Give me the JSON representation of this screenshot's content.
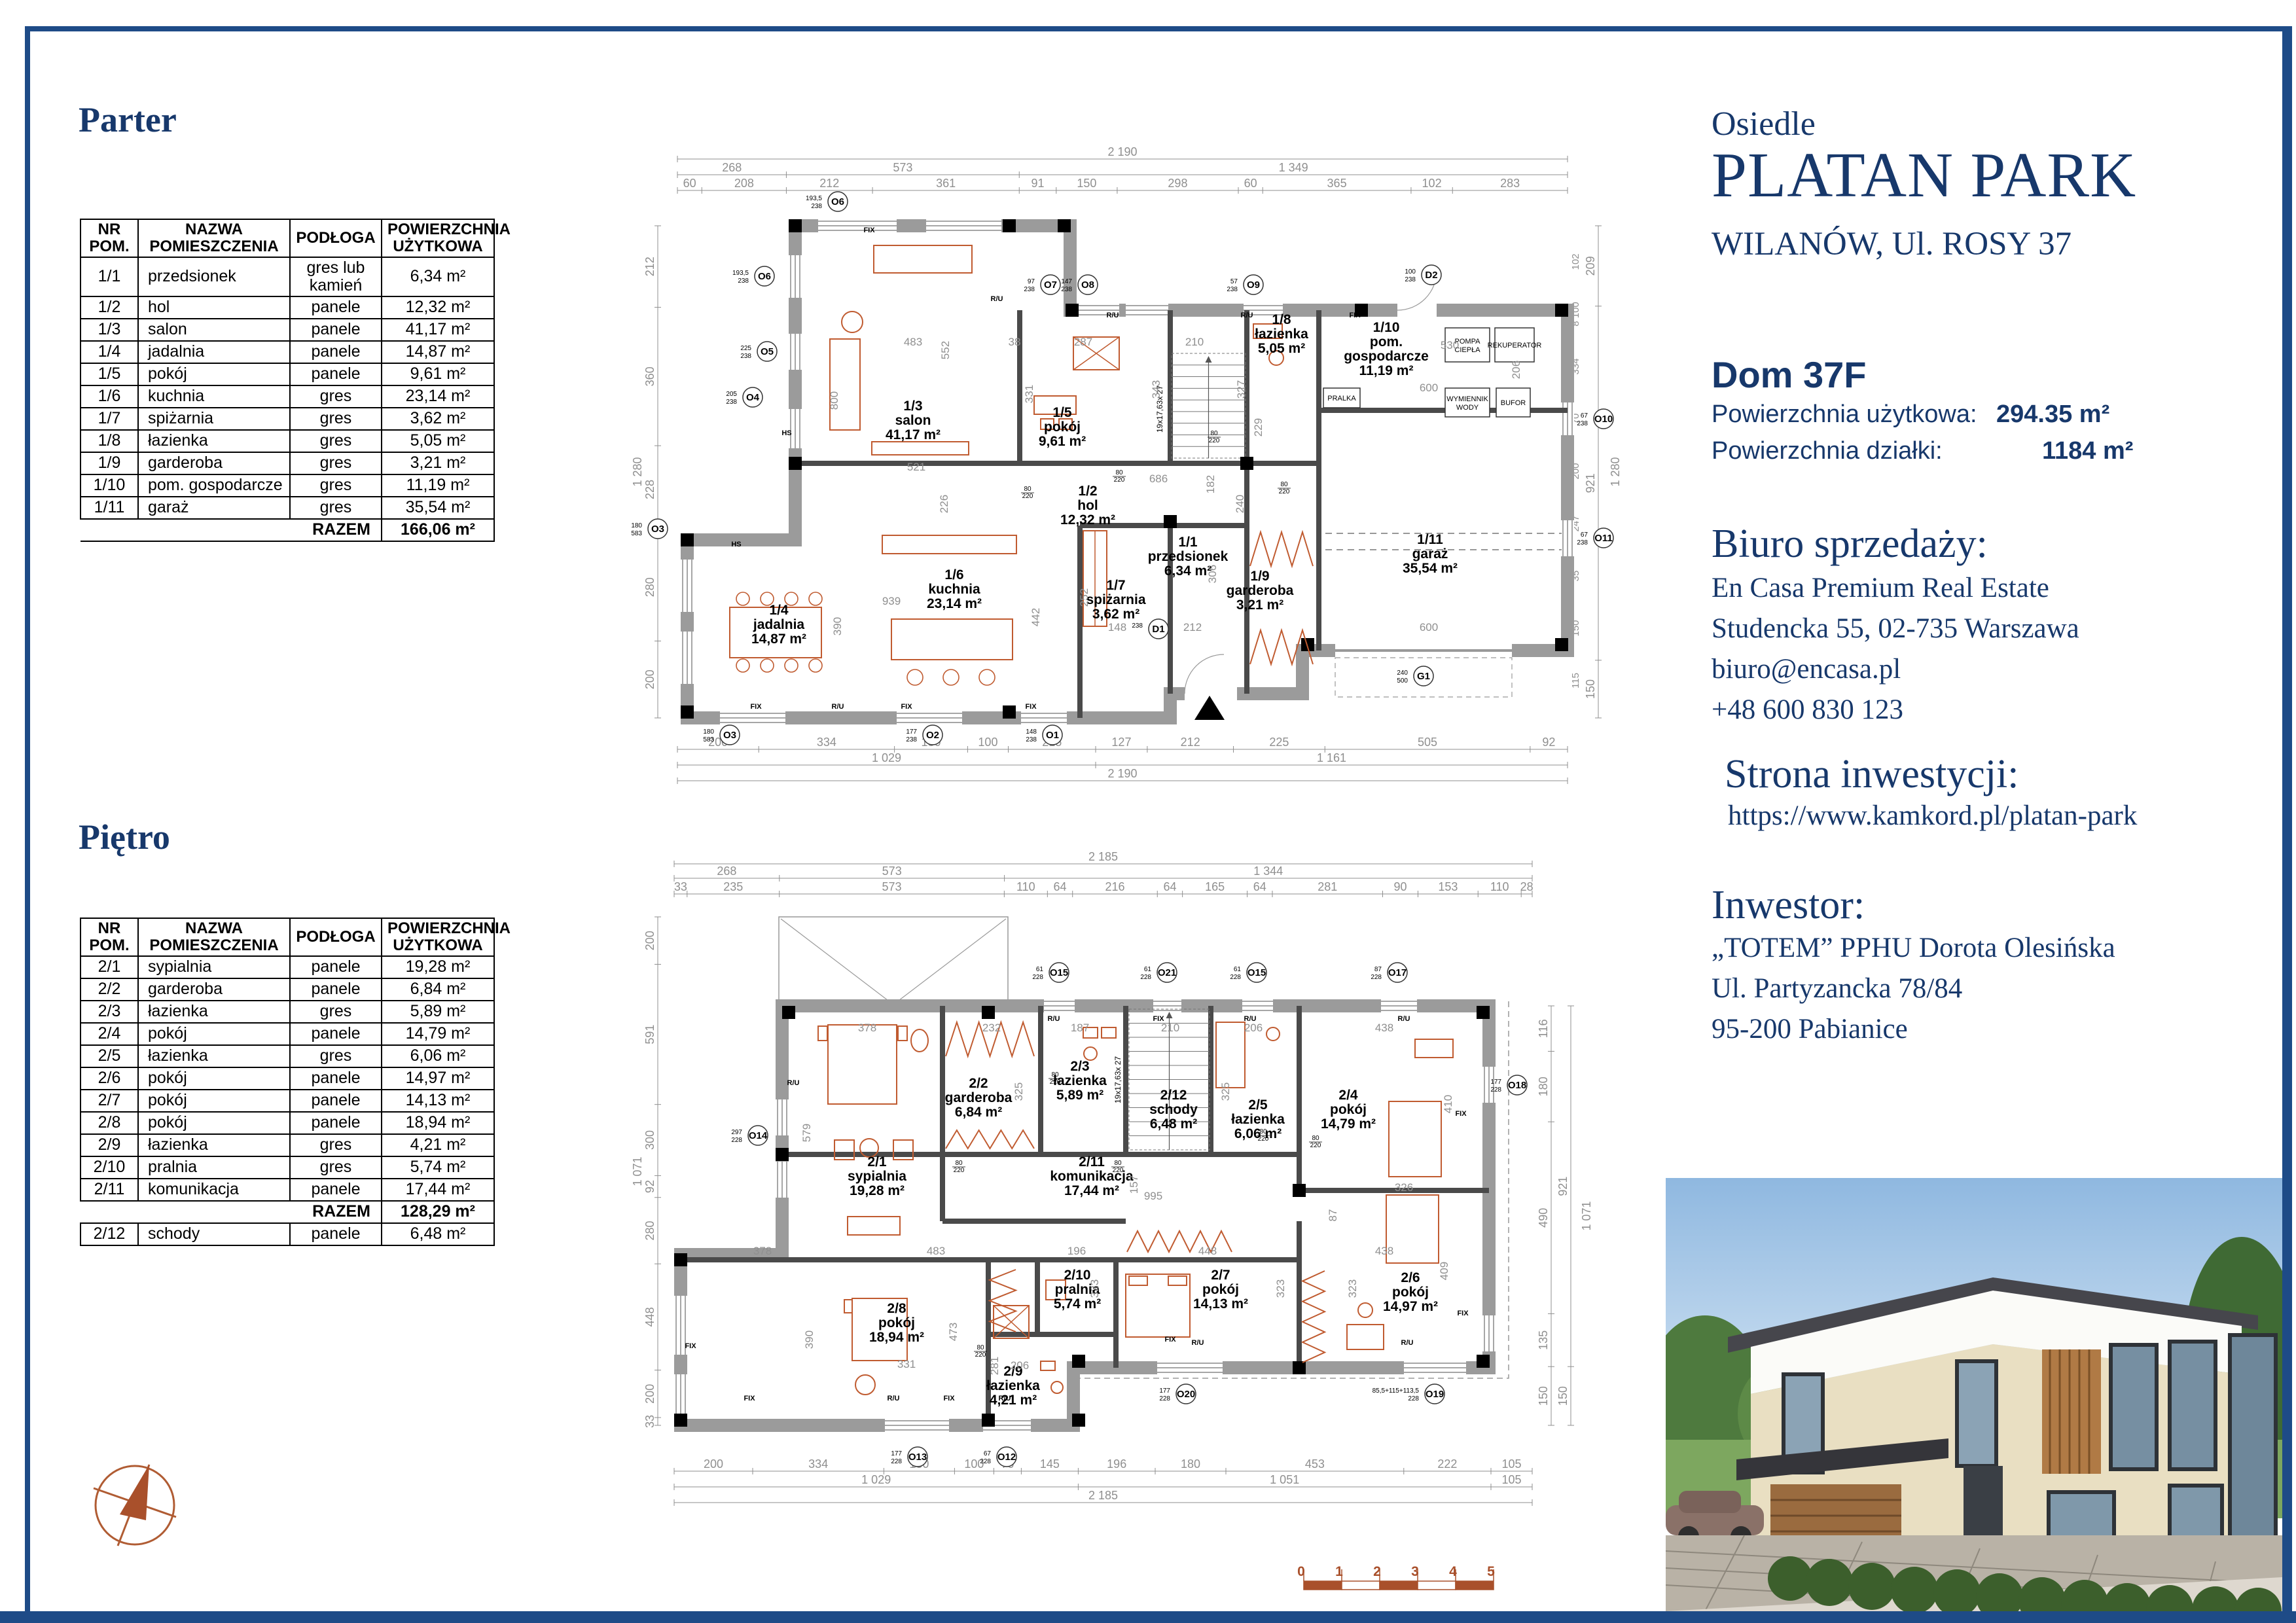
{
  "titles": {
    "parter": "Parter",
    "pietro": "Piętro"
  },
  "colors": {
    "navy": "#17386b",
    "frame": "#1e4b87",
    "orange": "#a9502b",
    "furniture": "#c05b30",
    "wall": "#9b9b9b",
    "dim": "#8f8f8f"
  },
  "tables": {
    "headers": [
      [
        "NR",
        "POM."
      ],
      [
        "NAZWA",
        "POMIESZCZENIA"
      ],
      [
        "PODŁOGA",
        ""
      ],
      [
        "POWIERZCHNIA",
        "UŻYTKOWA"
      ]
    ],
    "parter": {
      "rows": [
        {
          "nr": "1/1",
          "name": "przedsionek",
          "floor": "gres lub kamień",
          "area": "6,34 m²"
        },
        {
          "nr": "1/2",
          "name": "hol",
          "floor": "panele",
          "area": "12,32 m²"
        },
        {
          "nr": "1/3",
          "name": "salon",
          "floor": "panele",
          "area": "41,17 m²"
        },
        {
          "nr": "1/4",
          "name": "jadalnia",
          "floor": "panele",
          "area": "14,87 m²"
        },
        {
          "nr": "1/5",
          "name": "pokój",
          "floor": "panele",
          "area": "9,61 m²"
        },
        {
          "nr": "1/6",
          "name": "kuchnia",
          "floor": "gres",
          "area": "23,14 m²"
        },
        {
          "nr": "1/7",
          "name": "spiżarnia",
          "floor": "gres",
          "area": "3,62 m²"
        },
        {
          "nr": "1/8",
          "name": "łazienka",
          "floor": "gres",
          "area": "5,05 m²"
        },
        {
          "nr": "1/9",
          "name": "garderoba",
          "floor": "gres",
          "area": "3,21 m²"
        },
        {
          "nr": "1/10",
          "name": "pom. gospodarcze",
          "floor": "gres",
          "area": "11,19 m²"
        },
        {
          "nr": "1/11",
          "name": "garaż",
          "floor": "gres",
          "area": "35,54 m²"
        }
      ],
      "razem_label": "RAZEM",
      "razem": "166,06 m²"
    },
    "pietro": {
      "rows": [
        {
          "nr": "2/1",
          "name": "sypialnia",
          "floor": "panele",
          "area": "19,28 m²"
        },
        {
          "nr": "2/2",
          "name": "garderoba",
          "floor": "panele",
          "area": "6,84 m²"
        },
        {
          "nr": "2/3",
          "name": "łazienka",
          "floor": "gres",
          "area": "5,89 m²"
        },
        {
          "nr": "2/4",
          "name": "pokój",
          "floor": "panele",
          "area": "14,79 m²"
        },
        {
          "nr": "2/5",
          "name": "łazienka",
          "floor": "gres",
          "area": "6,06 m²"
        },
        {
          "nr": "2/6",
          "name": "pokój",
          "floor": "panele",
          "area": "14,97 m²"
        },
        {
          "nr": "2/7",
          "name": "pokój",
          "floor": "panele",
          "area": "14,13 m²"
        },
        {
          "nr": "2/8",
          "name": "pokój",
          "floor": "panele",
          "area": "18,94 m²"
        },
        {
          "nr": "2/9",
          "name": "łazienka",
          "floor": "gres",
          "area": "4,21 m²"
        },
        {
          "nr": "2/10",
          "name": "pralnia",
          "floor": "gres",
          "area": "5,74 m²"
        },
        {
          "nr": "2/11",
          "name": "komunikacja",
          "floor": "panele",
          "area": "17,44 m²"
        }
      ],
      "razem_label": "RAZEM",
      "razem": "128,29 m²",
      "extra_row": {
        "nr": "2/12",
        "name": "schody",
        "floor": "panele",
        "area": "6,48 m²"
      }
    }
  },
  "info": {
    "osiedle": "Osiedle",
    "brand": "PLATAN PARK",
    "address": "WILANÓW, Ul. ROSY 37",
    "dom": "Dom 37F",
    "area1_label": "Powierzchnia użytkowa:",
    "area1_value": "294.35 m²",
    "area2_label": "Powierzchnia działki:",
    "area2_value": "1184 m²",
    "office_title": "Biuro sprzedaży:",
    "office_lines": [
      "En Casa Premium Real Estate",
      "Studencka 55, 02-735 Warszawa",
      "biuro@encasa.pl",
      "+48 600 830 123"
    ],
    "site_title": "Strona inwestycji:",
    "site_url": "https://www.kamkord.pl/platan-park",
    "investor_title": "Inwestor:",
    "investor_lines": [
      "„TOTEM” PPHU Dorota Olesińska",
      "Ul. Partyzancka 78/84",
      "95-200 Pabianice"
    ]
  },
  "plans": {
    "parter": {
      "rooms": [
        {
          "id": "1/3",
          "name": "salon",
          "area": "41,17 m²"
        },
        {
          "id": "1/5",
          "name": "pokój",
          "area": "9,61 m²"
        },
        {
          "id": "1/8",
          "name": "łazienka",
          "area": "5,05 m²"
        },
        {
          "id": "1/10",
          "name": "pom. gospodarcze",
          "area": "11,19 m²"
        },
        {
          "id": "1/2",
          "name": "hol",
          "area": "12,32 m²"
        },
        {
          "id": "1/1",
          "name": "przedsionek",
          "area": "6,34 m²"
        },
        {
          "id": "1/7",
          "name": "spiżarnia",
          "area": "3,62 m²"
        },
        {
          "id": "1/9",
          "name": "garderoba",
          "area": "3,21 m²"
        },
        {
          "id": "1/6",
          "name": "kuchnia",
          "area": "23,14 m²"
        },
        {
          "id": "1/4",
          "name": "jadalnia",
          "area": "14,87 m²"
        },
        {
          "id": "1/11",
          "name": "garaż",
          "area": "35,54 m²"
        }
      ],
      "dim_total": "2 190",
      "dim_groups": [
        "268",
        "573",
        "1 349"
      ],
      "dim_top": [
        "60",
        "208",
        "212",
        "361",
        "91",
        "150",
        "298",
        "60",
        "365",
        "102",
        "283"
      ],
      "dim_bottom": [
        "200",
        "334",
        "180",
        "100",
        "215",
        "127",
        "212",
        "225",
        "505",
        "92"
      ],
      "dim_bottom_groups": [
        "1 029",
        "1 161"
      ],
      "dim_bottom_total": "2 190",
      "dim_left": [
        "212",
        "360",
        "228",
        "280",
        "200"
      ],
      "dim_left_total": "1 280",
      "dim_right": [
        "209",
        "921",
        "150"
      ],
      "dim_right_total": "1 280",
      "dim_right_extra": [
        "102",
        "8 100",
        "334",
        "70",
        "200",
        "247",
        "35",
        "150",
        "115"
      ],
      "interior_dims": [
        "483",
        "552",
        "38",
        "287",
        "210",
        "331",
        "343",
        "327",
        "229",
        "530",
        "206",
        "600",
        "686",
        "226",
        "800",
        "521",
        "939",
        "390",
        "442",
        "252",
        "148",
        "212",
        "306",
        "240",
        "600",
        "182"
      ],
      "markers": [
        "O6",
        "O6",
        "O7",
        "O8",
        "O9",
        "D2",
        "O5",
        "O4",
        "O3",
        "O3",
        "O2",
        "O1",
        "O10",
        "O11",
        "D1",
        "G1"
      ],
      "marker_subs": [
        "193,5|238",
        "193,5|238",
        "97|238",
        "147|238",
        "57|238",
        "100|238",
        "225|238",
        "205|238",
        "180|583",
        "180|583",
        "177|238",
        "148|238",
        "67|238",
        "67|238",
        "238|",
        "240|500"
      ],
      "equipment": [
        "PRALKA",
        "POMPA CIEPŁA",
        "REKUPERATOR",
        "WYMIENNIK WODY",
        "BUFOR"
      ],
      "door_dim": "80|220",
      "stairs_label": "19x17,63x 27",
      "win_labels": [
        "FIX",
        "R/U",
        "HS"
      ]
    },
    "pietro": {
      "rooms": [
        {
          "id": "2/1",
          "name": "sypialnia",
          "area": "19,28 m²"
        },
        {
          "id": "2/2",
          "name": "garderoba",
          "area": "6,84 m²"
        },
        {
          "id": "2/3",
          "name": "łazienka",
          "area": "5,89 m²"
        },
        {
          "id": "2/12",
          "name": "schody",
          "area": "6,48 m²"
        },
        {
          "id": "2/5",
          "name": "łazienka",
          "area": "6,06 m²"
        },
        {
          "id": "2/4",
          "name": "pokój",
          "area": "14,79 m²"
        },
        {
          "id": "2/11",
          "name": "komunikacja",
          "area": "17,44 m²"
        },
        {
          "id": "2/10",
          "name": "pralnia",
          "area": "5,74 m²"
        },
        {
          "id": "2/7",
          "name": "pokój",
          "area": "14,13 m²"
        },
        {
          "id": "2/6",
          "name": "pokój",
          "area": "14,97 m²"
        },
        {
          "id": "2/8",
          "name": "pokój",
          "area": "18,94 m²"
        },
        {
          "id": "2/9",
          "name": "łazienka",
          "area": "4,21 m²"
        }
      ],
      "dim_total": "2 185",
      "dim_groups": [
        "268",
        "573",
        "1 344"
      ],
      "dim_top": [
        "33",
        "235",
        "573",
        "110",
        "64",
        "216",
        "64",
        "165",
        "64",
        "281",
        "90",
        "153",
        "110",
        "28"
      ],
      "dim_bottom": [
        "200",
        "334",
        "180",
        "100",
        "70",
        "145",
        "196",
        "180",
        "453",
        "222",
        "105"
      ],
      "dim_bottom_groups": [
        "1 029",
        "1 051",
        "105"
      ],
      "dim_bottom_total": "2 185",
      "dim_left": [
        "200",
        "591",
        "300",
        "92",
        "280",
        "448",
        "200",
        "33"
      ],
      "dim_left_total": "1 071",
      "dim_right": [
        "116",
        "180",
        "490",
        "135",
        "150"
      ],
      "dim_right_outer": [
        "921",
        "150"
      ],
      "dim_right_total": "1 071",
      "interior_dims": [
        "378",
        "232",
        "187",
        "210",
        "206",
        "438",
        "325",
        "325",
        "579",
        "410",
        "483",
        "378",
        "196",
        "448",
        "438",
        "323",
        "323",
        "323",
        "409",
        "390",
        "331",
        "473",
        "281",
        "206",
        "995",
        "157",
        "87",
        "326"
      ],
      "markers": [
        "O15",
        "O21",
        "O15",
        "O17",
        "O14",
        "O18",
        "O13",
        "O12",
        "O20",
        "O19"
      ],
      "marker_subs": [
        "61|228",
        "61|228",
        "61|228",
        "87|228",
        "297|228",
        "177|228",
        "177|228",
        "67|228",
        "177|228",
        "85,5+115+113,5|228"
      ],
      "door_dim": "80|220",
      "stairs_label": "19x17,63x 27",
      "win_labels": [
        "FIX",
        "R/U"
      ]
    }
  },
  "scalebar": {
    "numbers": [
      "0",
      "1",
      "2",
      "3",
      "4",
      "5"
    ]
  }
}
